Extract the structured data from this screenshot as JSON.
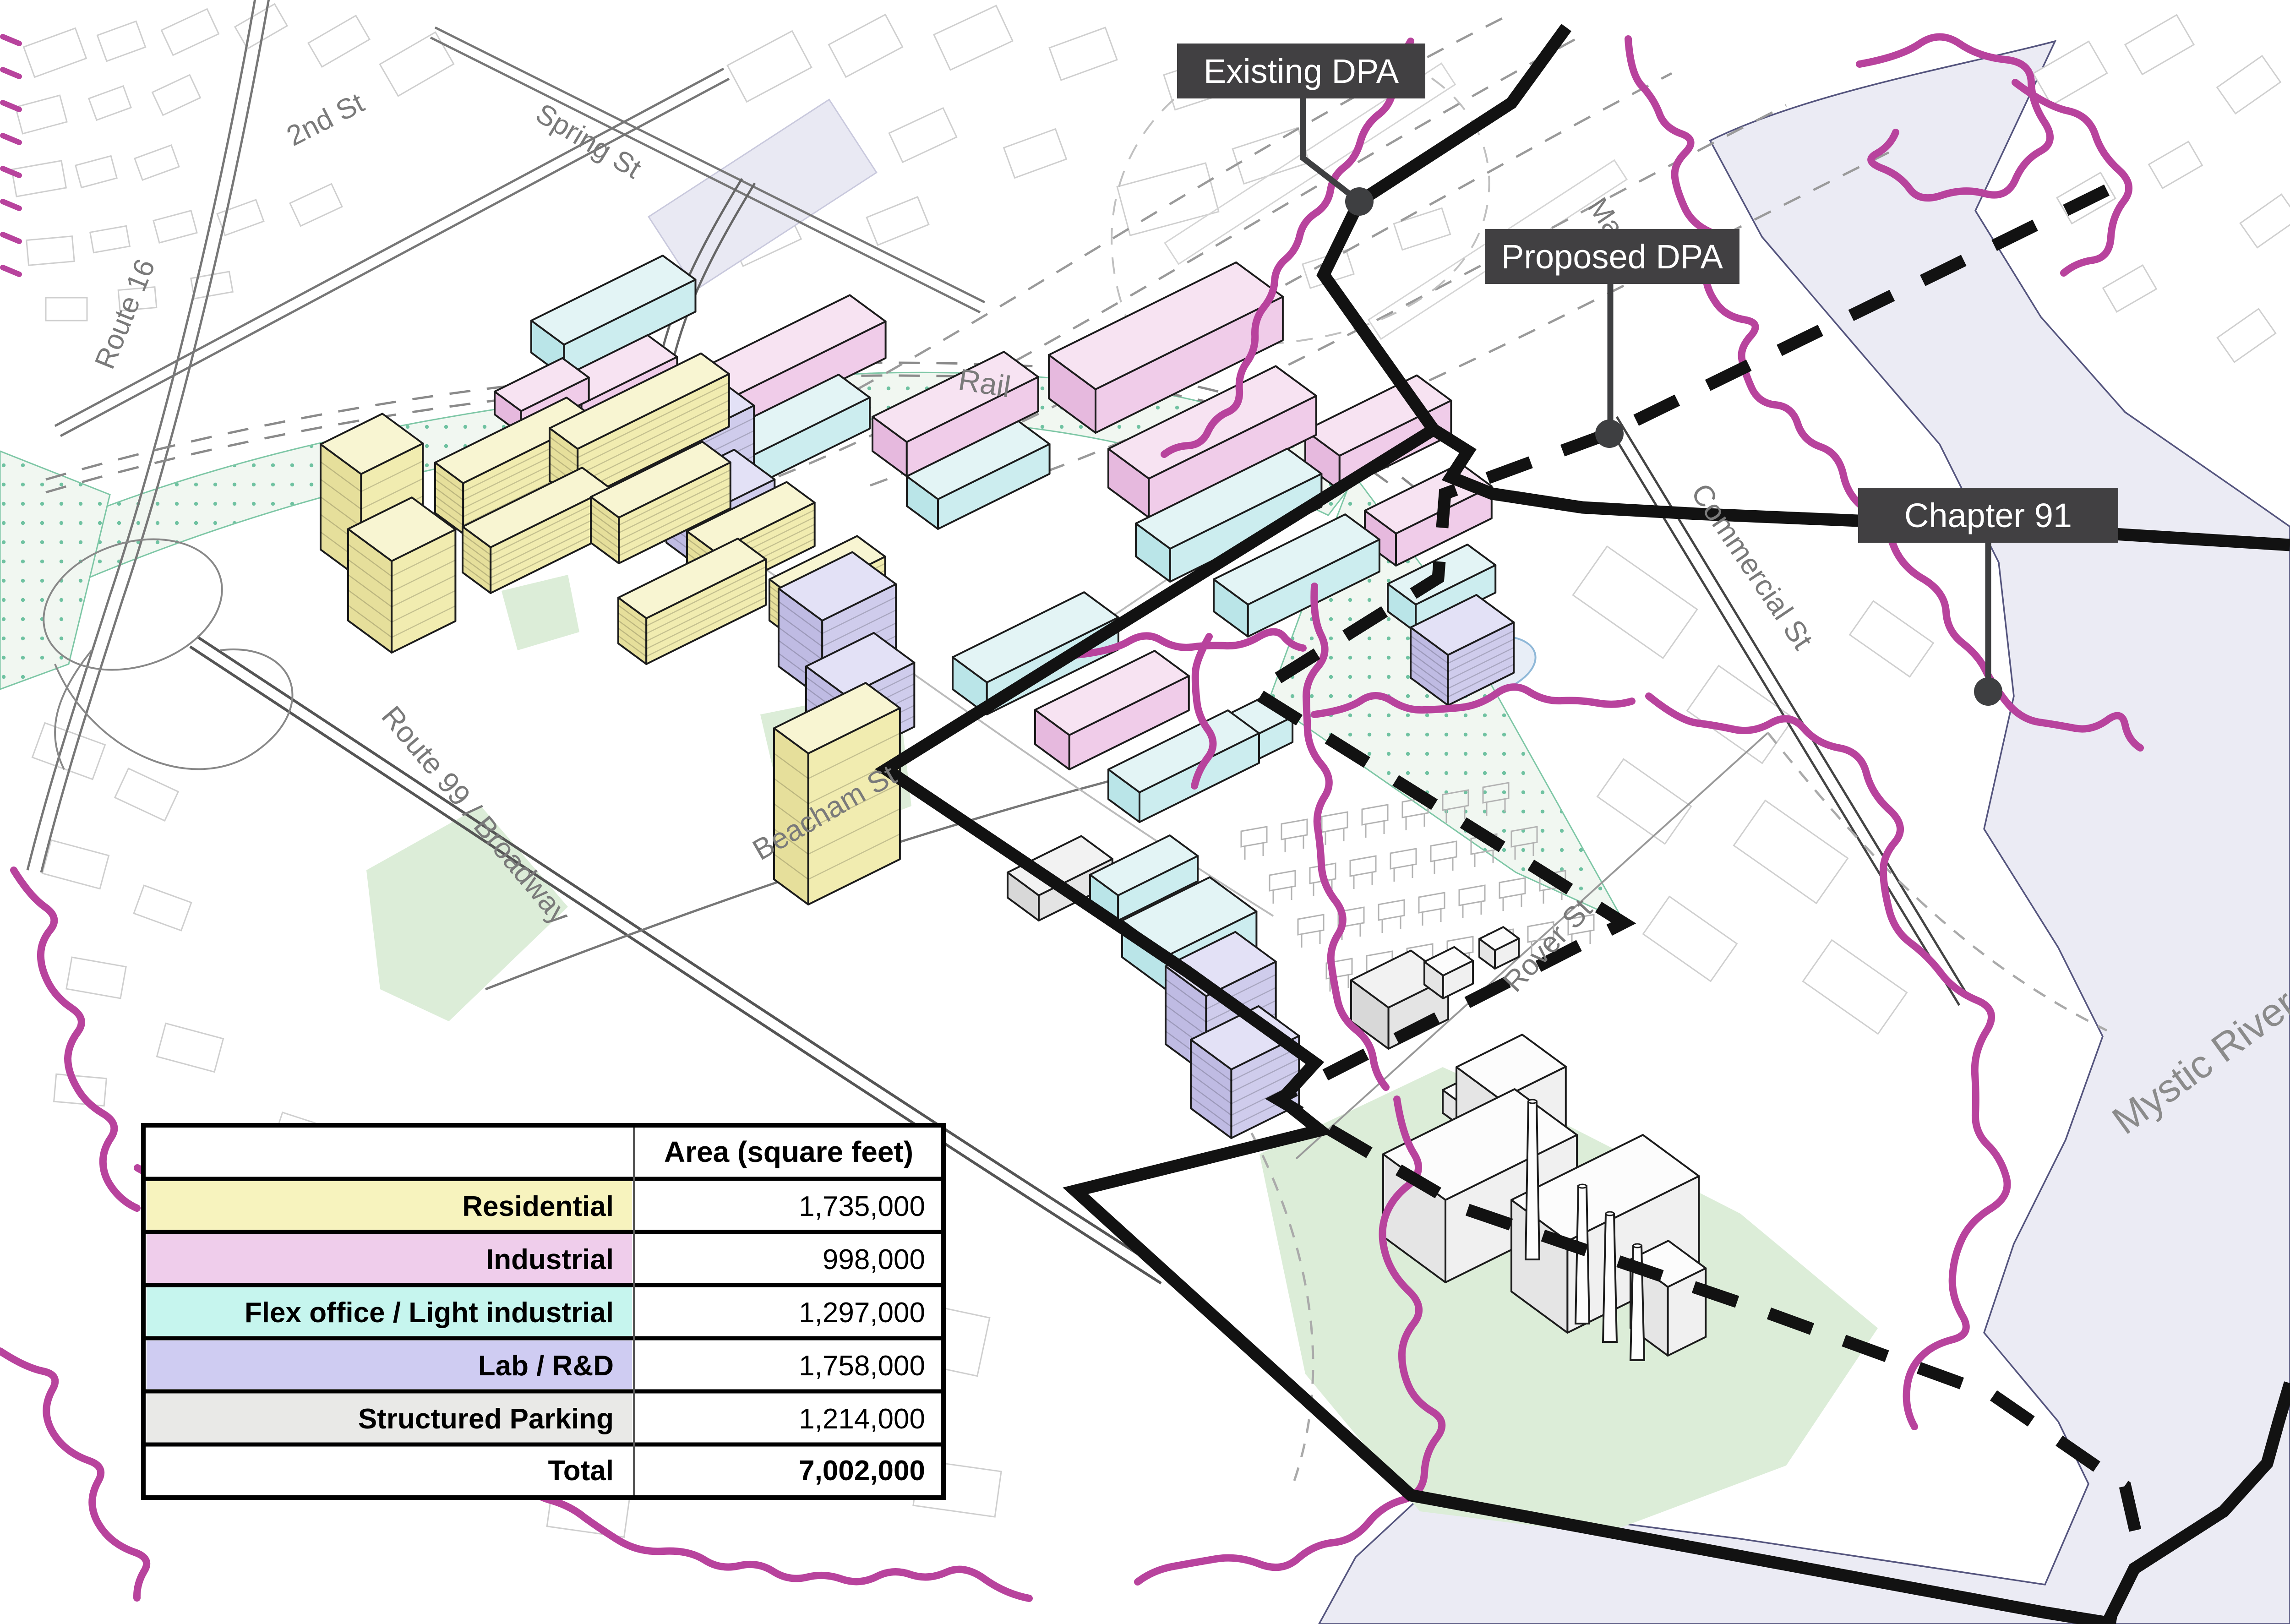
{
  "map": {
    "street_labels": [
      {
        "id": "2nd-st",
        "text": "2nd St"
      },
      {
        "id": "spring-st",
        "text": "Spring St"
      },
      {
        "id": "route-16",
        "text": "Route 16"
      },
      {
        "id": "rail",
        "text": "Rail"
      },
      {
        "id": "route-99-broadway",
        "text": "Route 99 / Broadway"
      },
      {
        "id": "beacham-st",
        "text": "Beacham St"
      },
      {
        "id": "commercial-st",
        "text": "Commercial St"
      },
      {
        "id": "rover-st",
        "text": "Rover St"
      },
      {
        "id": "mystic-river",
        "text": "Mystic River"
      },
      {
        "id": "main-st-partial",
        "text": "Ma"
      }
    ],
    "callouts": [
      {
        "id": "existing-dpa",
        "label": "Existing DPA"
      },
      {
        "id": "proposed-dpa",
        "label": "Proposed DPA"
      },
      {
        "id": "chapter-91",
        "label": "Chapter 91"
      }
    ]
  },
  "table": {
    "header": "Area (square feet)",
    "rows": [
      {
        "label": "Residential",
        "value": "1,735,000",
        "color": "#F7F3BE"
      },
      {
        "label": "Industrial",
        "value": "998,000",
        "color": "#EFCDEB"
      },
      {
        "label": "Flex office / Light industrial",
        "value": "1,297,000",
        "color": "#C6F5EE"
      },
      {
        "label": "Lab / R&D",
        "value": "1,758,000",
        "color": "#CFCCF2"
      },
      {
        "label": "Structured Parking",
        "value": "1,214,000",
        "color": "#E9E9E7"
      }
    ],
    "total": {
      "label": "Total",
      "value": "7,002,000"
    }
  },
  "colors": {
    "residential": "#F7F3BE",
    "industrial": "#EFCDEB",
    "flex_office": "#C6F5EE",
    "lab_rd": "#CFCCF2",
    "structured_parking": "#E9E9E7",
    "water": "#EBEBF4",
    "water_edge": "#55557E",
    "park_green": "#DCEDD8",
    "open_space_dot": "#6FC2A1",
    "chapter91_magenta": "#B8439D",
    "boundary_black": "#121212",
    "callout_bg": "#414042",
    "callout_text": "#FFFFFF",
    "street_label": "#7A7A7A"
  }
}
